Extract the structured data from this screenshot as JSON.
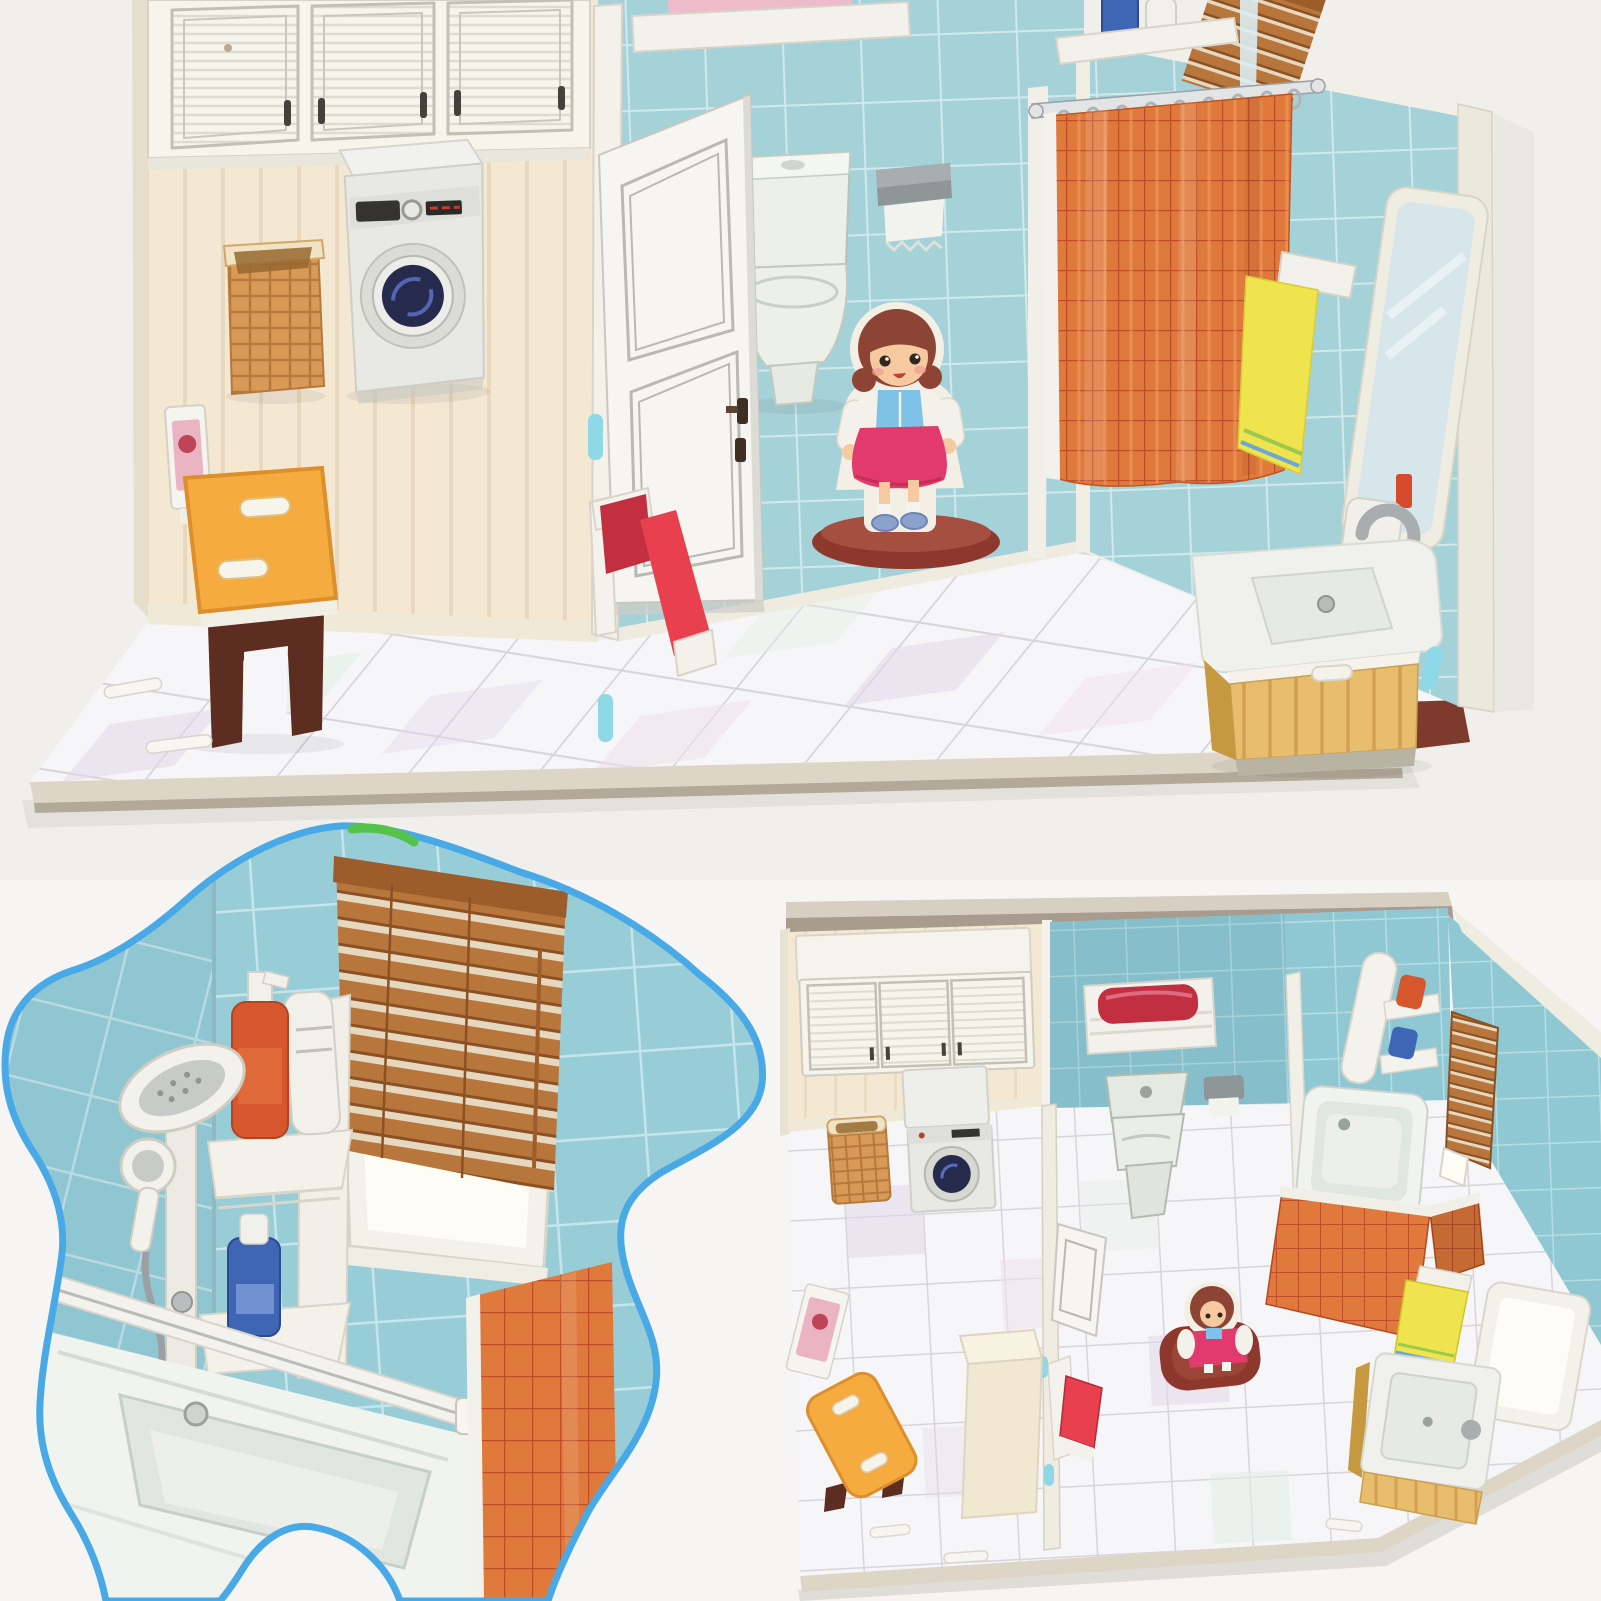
{
  "image": {
    "kind": "product photo collage",
    "subject": "3D paper puzzle bathroom dollhouse with cardboard furniture and a girl figure",
    "views": {
      "main": "assembled model, front view",
      "detail": "bathtub and shower close-up in splat-shaped callout",
      "overhead": "assembled model, overhead view"
    }
  },
  "objects": {
    "main": [
      "wall cabinets",
      "laundry wall",
      "washing machine",
      "laundry basket",
      "laundry sign",
      "step stool",
      "storage cabinet",
      "open door",
      "red towel on door",
      "toilet",
      "toilet paper holder",
      "shelf with pink towel",
      "girl figure",
      "shower curtain",
      "curtain rail",
      "corner shelf with bottles",
      "window blinds corner",
      "yellow towel",
      "sink vanity",
      "mirror",
      "tiled floor platform",
      "loose paper pieces"
    ],
    "detail": [
      "tiled walls",
      "venetian blinds",
      "window",
      "shower panel",
      "hand shower",
      "corner shelves",
      "shampoo bottles",
      "curtain rail",
      "bathtub",
      "shower curtain edge"
    ],
    "overhead": [
      "wall cabinets",
      "washing machine",
      "laundry basket",
      "step stool",
      "laundry sign",
      "towel shelf with red towel",
      "toilet",
      "toilet paper holder",
      "partition wall",
      "open door",
      "red towel",
      "storage cabinet",
      "girl figure on rug",
      "bathtub",
      "shower curtain",
      "shelf with bottles",
      "mirror",
      "window blinds",
      "window",
      "yellow towel",
      "sink vanity",
      "tiled floor platform"
    ]
  },
  "palette": {
    "bg_top": "#f1efec",
    "bg_page": "#f6f5f3",
    "base_edge": "#ddd6c7",
    "base_edge_dark": "#b2a999",
    "base_shadow": "#deddd8",
    "base_corner": "#7e3a2c",
    "tile_blue": "#a5d2d9",
    "tile_grout": "#cfe9ec",
    "tile_blue_deep": "#98cdd8",
    "tile_grout_soft": "#c5e5eb",
    "over_tile": "#8fc8d2",
    "over_grout": "#b6dde3",
    "over_tile_dark": "#5a98a6",
    "floor_tile": "#f6f5f7",
    "floor_grout": "#d8d4dc",
    "tint_lavender": "#e2d8ec",
    "tint_pink": "#f1e1e9",
    "tint_mint": "#e1efe6",
    "cream_wall": "#f4e8d3",
    "cream_stripe": "#e5d2b6",
    "cream_base": "#f0e9d8",
    "wall_edge_light": "#e6decd",
    "cab_white": "#f7f4ec",
    "cab_line": "#c2c0b6",
    "cab_handle": "#44423c",
    "louver_line": "#dedbd0",
    "machine_body": "#e8e8e4",
    "machine_top": "#f1f1ee",
    "machine_panel": "#dededa",
    "machine_display": "#34332f",
    "machine_red": "#c33b2e",
    "drum_ring": "#ecece8",
    "drum_dark": "#262b4e",
    "drum_blue": "#5a6cc0",
    "basket": "#d99a58",
    "basket_line": "#b5793c",
    "basket_rim": "#f0e2c4",
    "basket_inner": "#96672f",
    "bench_top": "#f5ab3f",
    "bench_edge": "#dd8f2c",
    "bench_leg": "#5d2d21",
    "bench_trim": "#f2efe6",
    "sign_white": "#f6f4ef",
    "sign_pink": "#eab4c2",
    "sign_red": "#c04458",
    "cabinet_tall": "#f1e8d2",
    "cabinet_top": "#f7f2e2",
    "cabinet_side": "#e3d8bc",
    "door_white": "#f6f5f1",
    "door_line": "#b9b8b2",
    "knob": "#3f2e22",
    "frame_white": "#f3f1ea",
    "tab_cyan": "#8ed8e8",
    "towel_red": "#e8404e",
    "towel_red_deep": "#c22f40",
    "toilet_body": "#edf0e9",
    "toilet_line": "#b9c2b4",
    "paper_gray": "#8f9698",
    "paper_white": "#f3f3ee",
    "shelf_white": "#f3f1ec",
    "towel_pink": "#eebbca",
    "curtain": "#e07a3c",
    "curtain_line": "#bf4e28",
    "curtain_hi": "#f19d62",
    "rail_silver": "#e3e4e5",
    "rail_dark": "#9aa0a4",
    "ring_gray": "#aeb4b8",
    "mirror_frame": "#efece2",
    "mirror_glass": "#d7e6ea",
    "mirror_sheen": "#f0f7f8",
    "towel_yellow": "#efe44e",
    "towel_stripe_g": "#9cc84e",
    "towel_stripe_b": "#6aa8d8",
    "vanity_white": "#f0f1ed",
    "vanity_basin": "#e7eae4",
    "wood": "#e9bd6e",
    "wood_line": "#d3a054",
    "wood_dark": "#c6983f",
    "faucet": "#a9adb0",
    "girl_hair": "#8e4435",
    "girl_skin": "#f6c9a0",
    "girl_blush": "#f09e96",
    "girl_eye_dark": "#33241c",
    "girl_jacket": "#f4f1ea",
    "girl_top": "#7fc2e8",
    "girl_skirt": "#e23a6c",
    "girl_sock": "#f4f3f0",
    "girl_shoe": "#8ba2cc",
    "girl_base": "#8e372c",
    "girl_outline": "#f4efe4",
    "rug_hi": "#a44f3f",
    "blob_stroke": "#49a9e6",
    "blob_green": "#55c24c",
    "blinds": "#b9763c",
    "blinds_dark": "#8a5124",
    "blinds_gap": "#e6d8bf",
    "blinds_rail": "#9c5d2a",
    "window_frame": "#f3f2ea",
    "window_glass": "#fdfdf6",
    "bottle_red": "#d6572e",
    "bottle_white": "#f2f0ea",
    "bottle_blue": "#3f66b4",
    "bottle_blue_label": "#7291d2",
    "shower_white": "#f2f1ec",
    "shower_face": "#c7cac6",
    "shower_metal": "#9aa0a4",
    "tub_white": "#f1f3ef",
    "tub_wall": "#e0e6e1",
    "tub_floor": "#edf0ea",
    "tub_line": "#c6cfc9",
    "over_edge_light": "#d7cfc2",
    "over_edge_dark": "#a89c8e"
  }
}
